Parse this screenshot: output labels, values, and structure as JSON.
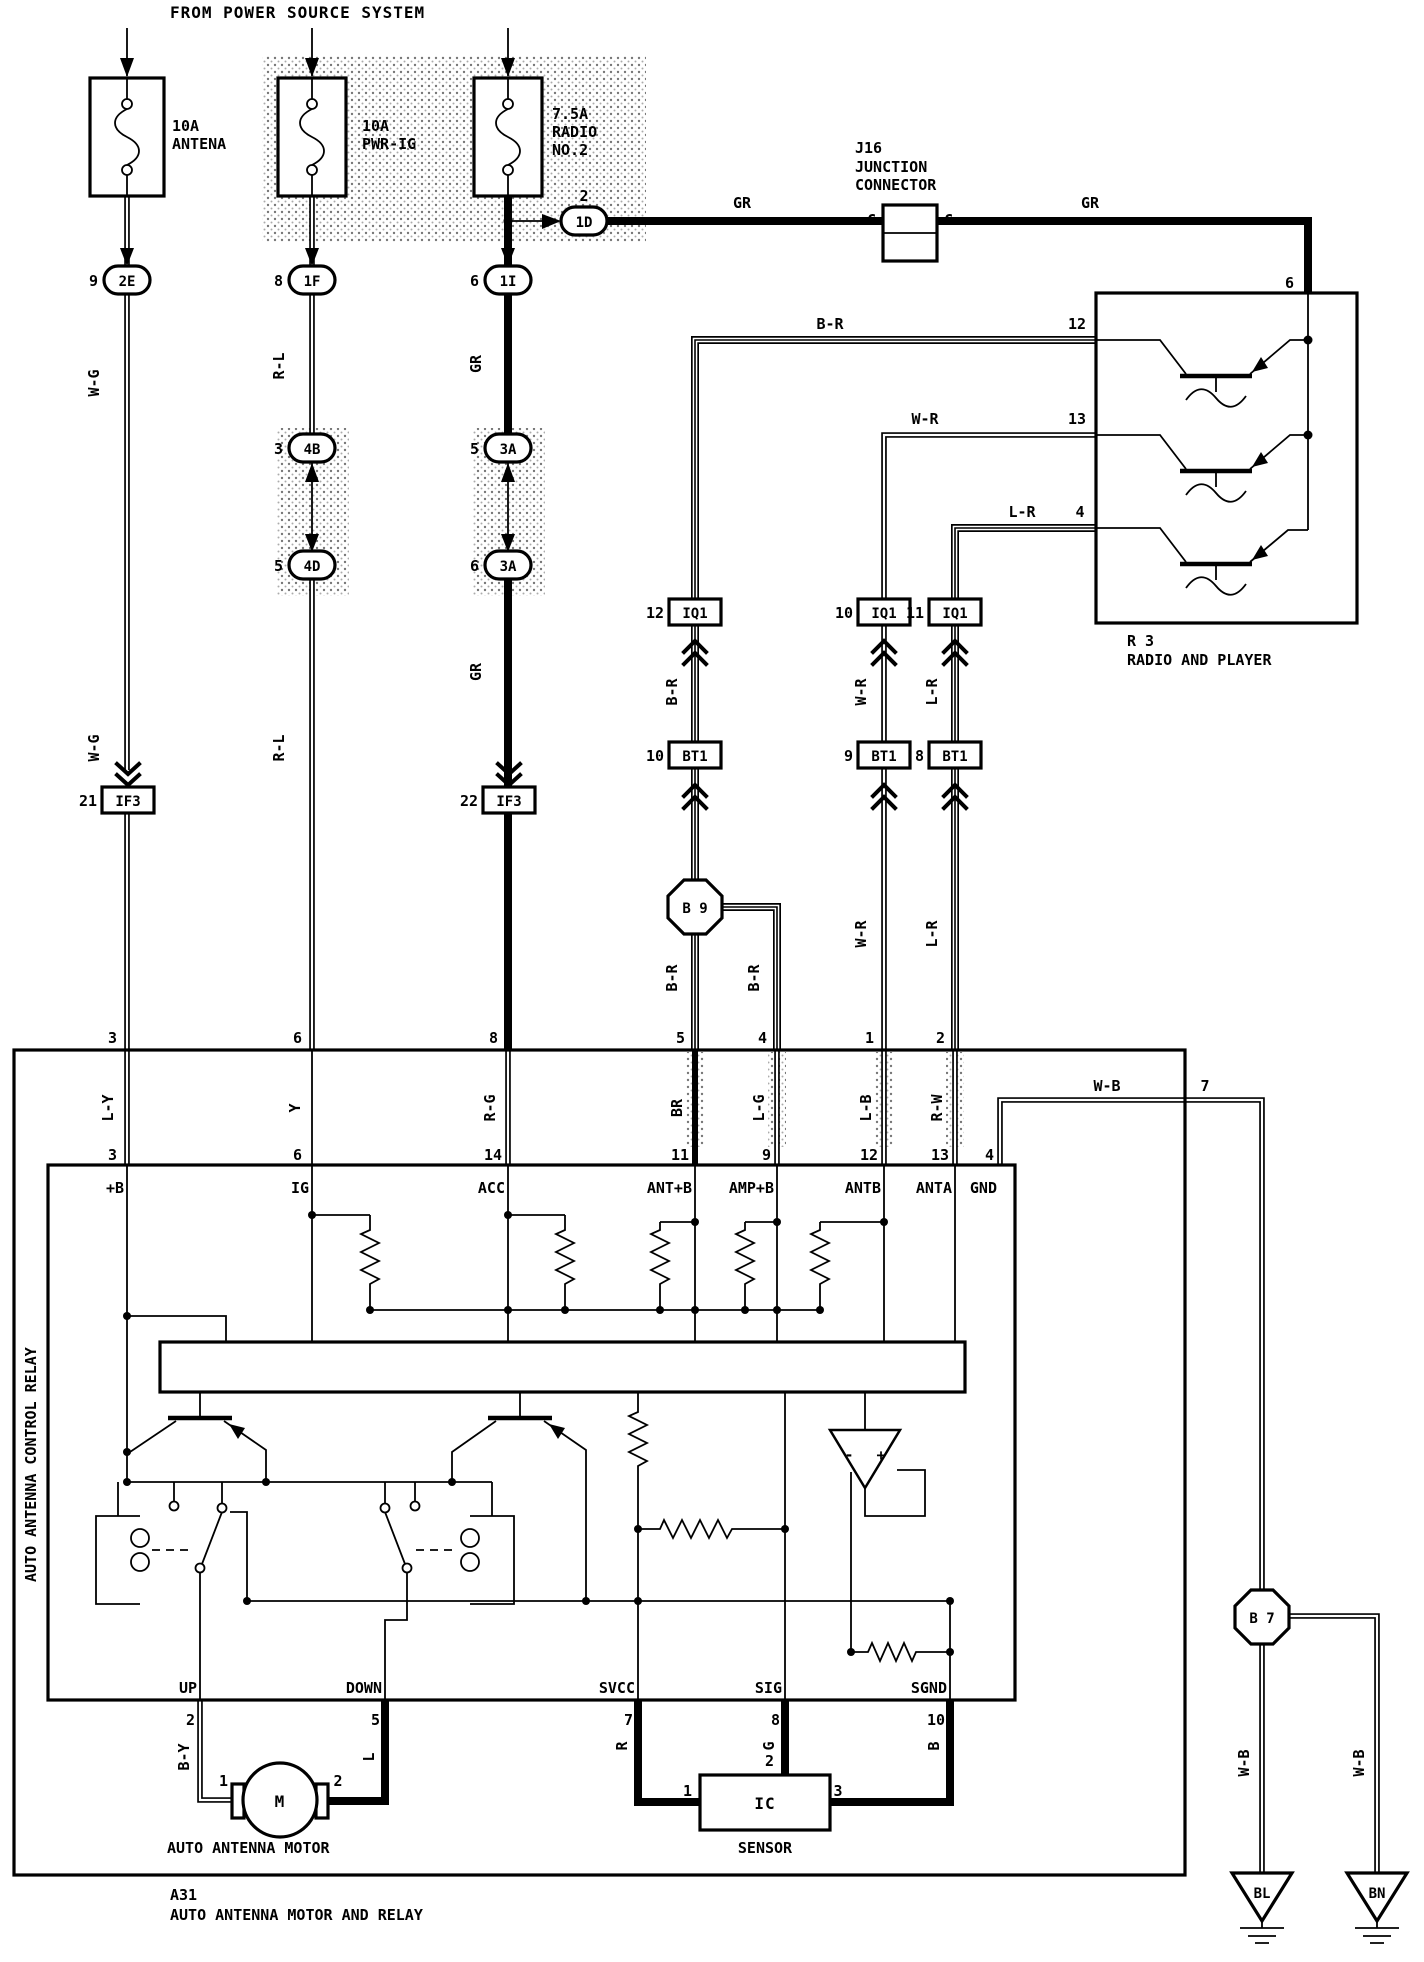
{
  "colors": {
    "ink": "#000000",
    "paper": "#ffffff",
    "stipple": "#8a8a8a"
  },
  "header": {
    "title": "FROM POWER SOURCE SYSTEM"
  },
  "fuses": [
    {
      "rating": "10A",
      "name": "ANTENA"
    },
    {
      "rating": "10A",
      "name": "PWR-IG"
    },
    {
      "rating": "7.5A",
      "name": "RADIO",
      "name2": "NO.2"
    }
  ],
  "j16": {
    "id": "J16",
    "type1": "JUNCTION",
    "type2": "CONNECTOR",
    "c_left": "C",
    "c_right": "C"
  },
  "radio": {
    "id": "R 3",
    "name": "RADIO AND PLAYER"
  },
  "ovals": [
    {
      "id": "2E",
      "pin": "9"
    },
    {
      "id": "1F",
      "pin": "8"
    },
    {
      "id": "1I",
      "pin": "6"
    },
    {
      "id": "4B",
      "pin": "3"
    },
    {
      "id": "4D",
      "pin": "5"
    },
    {
      "id": "3A",
      "pin": "5"
    },
    {
      "id": "3A",
      "pin": "6"
    },
    {
      "id": "1D",
      "pin": "2"
    }
  ],
  "sq": [
    {
      "id": "IF3",
      "pin": "21"
    },
    {
      "id": "IF3",
      "pin": "22"
    },
    {
      "id": "IQ1",
      "pin": "12"
    },
    {
      "id": "IQ1",
      "pin": "10"
    },
    {
      "id": "IQ1",
      "pin": "11"
    },
    {
      "id": "BT1",
      "pin": "10"
    },
    {
      "id": "BT1",
      "pin": "9"
    },
    {
      "id": "BT1",
      "pin": "8"
    }
  ],
  "octagons": [
    {
      "id": "B 9"
    },
    {
      "id": "B 7"
    }
  ],
  "a31": {
    "id": "A31",
    "name": "AUTO ANTENNA MOTOR AND RELAY"
  },
  "relay": {
    "name": "AUTO ANTENNA CONTROL RELAY"
  },
  "motor": {
    "symbol": "M",
    "name": "AUTO ANTENNA MOTOR"
  },
  "sensor": {
    "id": "IC",
    "name": "SENSOR"
  },
  "grounds": [
    {
      "id": "BL"
    },
    {
      "id": "BN"
    }
  ],
  "texts": [
    {
      "t": "W-G",
      "x": 99,
      "y": 383,
      "r": -90
    },
    {
      "t": "W-G",
      "x": 99,
      "y": 748,
      "r": -90
    },
    {
      "t": "R-L",
      "x": 284,
      "y": 366,
      "r": -90
    },
    {
      "t": "R-L",
      "x": 284,
      "y": 748,
      "r": -90
    },
    {
      "t": "GR",
      "x": 481,
      "y": 364,
      "r": -90
    },
    {
      "t": "GR",
      "x": 481,
      "y": 672,
      "r": -90
    },
    {
      "t": "GR",
      "x": 742,
      "y": 208
    },
    {
      "t": "GR",
      "x": 1090,
      "y": 208
    },
    {
      "t": "B-R",
      "x": 830,
      "y": 329
    },
    {
      "t": "12",
      "x": 1077,
      "y": 329
    },
    {
      "t": "W-R",
      "x": 925,
      "y": 424
    },
    {
      "t": "13",
      "x": 1077,
      "y": 424
    },
    {
      "t": "L-R",
      "x": 1022,
      "y": 517
    },
    {
      "t": "4",
      "x": 1080,
      "y": 517
    },
    {
      "t": "6",
      "x": 1294,
      "y": 288,
      "a": "e"
    },
    {
      "t": "B-R",
      "x": 677,
      "y": 692,
      "r": -90
    },
    {
      "t": "W-R",
      "x": 866,
      "y": 692,
      "r": -90
    },
    {
      "t": "L-R",
      "x": 937,
      "y": 692,
      "r": -90
    },
    {
      "t": "B-R",
      "x": 677,
      "y": 978,
      "r": -90
    },
    {
      "t": "B-R",
      "x": 759,
      "y": 978,
      "r": -90
    },
    {
      "t": "W-R",
      "x": 866,
      "y": 934,
      "r": -90
    },
    {
      "t": "L-R",
      "x": 937,
      "y": 934,
      "r": -90
    },
    {
      "t": "3",
      "x": 117,
      "y": 1043,
      "a": "e"
    },
    {
      "t": "6",
      "x": 302,
      "y": 1043,
      "a": "e"
    },
    {
      "t": "8",
      "x": 498,
      "y": 1043,
      "a": "e"
    },
    {
      "t": "5",
      "x": 685,
      "y": 1043,
      "a": "e"
    },
    {
      "t": "4",
      "x": 767,
      "y": 1043,
      "a": "e"
    },
    {
      "t": "1",
      "x": 874,
      "y": 1043,
      "a": "e"
    },
    {
      "t": "2",
      "x": 945,
      "y": 1043,
      "a": "e"
    },
    {
      "t": "L-Y",
      "x": 113,
      "y": 1108,
      "r": -90
    },
    {
      "t": "Y",
      "x": 300,
      "y": 1108,
      "r": -90
    },
    {
      "t": "R-G",
      "x": 495,
      "y": 1108,
      "r": -90
    },
    {
      "t": "BR",
      "x": 682,
      "y": 1108,
      "r": -90
    },
    {
      "t": "L-G",
      "x": 764,
      "y": 1108,
      "r": -90
    },
    {
      "t": "L-B",
      "x": 871,
      "y": 1108,
      "r": -90
    },
    {
      "t": "R-W",
      "x": 942,
      "y": 1108,
      "r": -90
    },
    {
      "t": "W-B",
      "x": 1107,
      "y": 1091
    },
    {
      "t": "7",
      "x": 1205,
      "y": 1091
    },
    {
      "t": "3",
      "x": 117,
      "y": 1160,
      "a": "e"
    },
    {
      "t": "6",
      "x": 302,
      "y": 1160,
      "a": "e"
    },
    {
      "t": "14",
      "x": 502,
      "y": 1160,
      "a": "e"
    },
    {
      "t": "11",
      "x": 689,
      "y": 1160,
      "a": "e"
    },
    {
      "t": "9",
      "x": 771,
      "y": 1160,
      "a": "e"
    },
    {
      "t": "12",
      "x": 878,
      "y": 1160,
      "a": "e"
    },
    {
      "t": "13",
      "x": 949,
      "y": 1160,
      "a": "e"
    },
    {
      "t": "4",
      "x": 994,
      "y": 1160,
      "a": "e"
    },
    {
      "t": "+B",
      "x": 124,
      "y": 1193,
      "a": "e"
    },
    {
      "t": "IG",
      "x": 309,
      "y": 1193,
      "a": "e"
    },
    {
      "t": "ACC",
      "x": 505,
      "y": 1193,
      "a": "e"
    },
    {
      "t": "ANT+B",
      "x": 692,
      "y": 1193,
      "a": "e"
    },
    {
      "t": "AMP+B",
      "x": 774,
      "y": 1193,
      "a": "e"
    },
    {
      "t": "ANTB",
      "x": 881,
      "y": 1193,
      "a": "e"
    },
    {
      "t": "ANTA",
      "x": 952,
      "y": 1193,
      "a": "e"
    },
    {
      "t": "GND",
      "x": 997,
      "y": 1193,
      "a": "e"
    },
    {
      "t": "UP",
      "x": 197,
      "y": 1693,
      "a": "e"
    },
    {
      "t": "DOWN",
      "x": 382,
      "y": 1693,
      "a": "e"
    },
    {
      "t": "SVCC",
      "x": 635,
      "y": 1693,
      "a": "e"
    },
    {
      "t": "SIG",
      "x": 782,
      "y": 1693,
      "a": "e"
    },
    {
      "t": "SGND",
      "x": 947,
      "y": 1693,
      "a": "e"
    },
    {
      "t": "2",
      "x": 195,
      "y": 1725,
      "a": "e"
    },
    {
      "t": "5",
      "x": 380,
      "y": 1725,
      "a": "e"
    },
    {
      "t": "7",
      "x": 633,
      "y": 1725,
      "a": "e"
    },
    {
      "t": "8",
      "x": 780,
      "y": 1725,
      "a": "e"
    },
    {
      "t": "10",
      "x": 945,
      "y": 1725,
      "a": "e"
    },
    {
      "t": "B-Y",
      "x": 189,
      "y": 1757,
      "r": -90
    },
    {
      "t": "L",
      "x": 374,
      "y": 1757,
      "r": -90
    },
    {
      "t": "R",
      "x": 627,
      "y": 1746,
      "r": -90
    },
    {
      "t": "G",
      "x": 774,
      "y": 1746,
      "r": -90
    },
    {
      "t": "B",
      "x": 939,
      "y": 1746,
      "r": -90
    },
    {
      "t": "W-B",
      "x": 1249,
      "y": 1763,
      "r": -90
    },
    {
      "t": "W-B",
      "x": 1364,
      "y": 1763,
      "r": -90
    },
    {
      "t": "1",
      "x": 228,
      "y": 1786,
      "a": "e"
    },
    {
      "t": "2",
      "x": 338,
      "y": 1786
    },
    {
      "t": "1",
      "x": 692,
      "y": 1796,
      "a": "e"
    },
    {
      "t": "2",
      "x": 774,
      "y": 1766,
      "a": "e"
    },
    {
      "t": "3",
      "x": 838,
      "y": 1796
    },
    {
      "t": "-",
      "x": 849,
      "y": 1460
    },
    {
      "t": "+",
      "x": 881,
      "y": 1460
    }
  ]
}
